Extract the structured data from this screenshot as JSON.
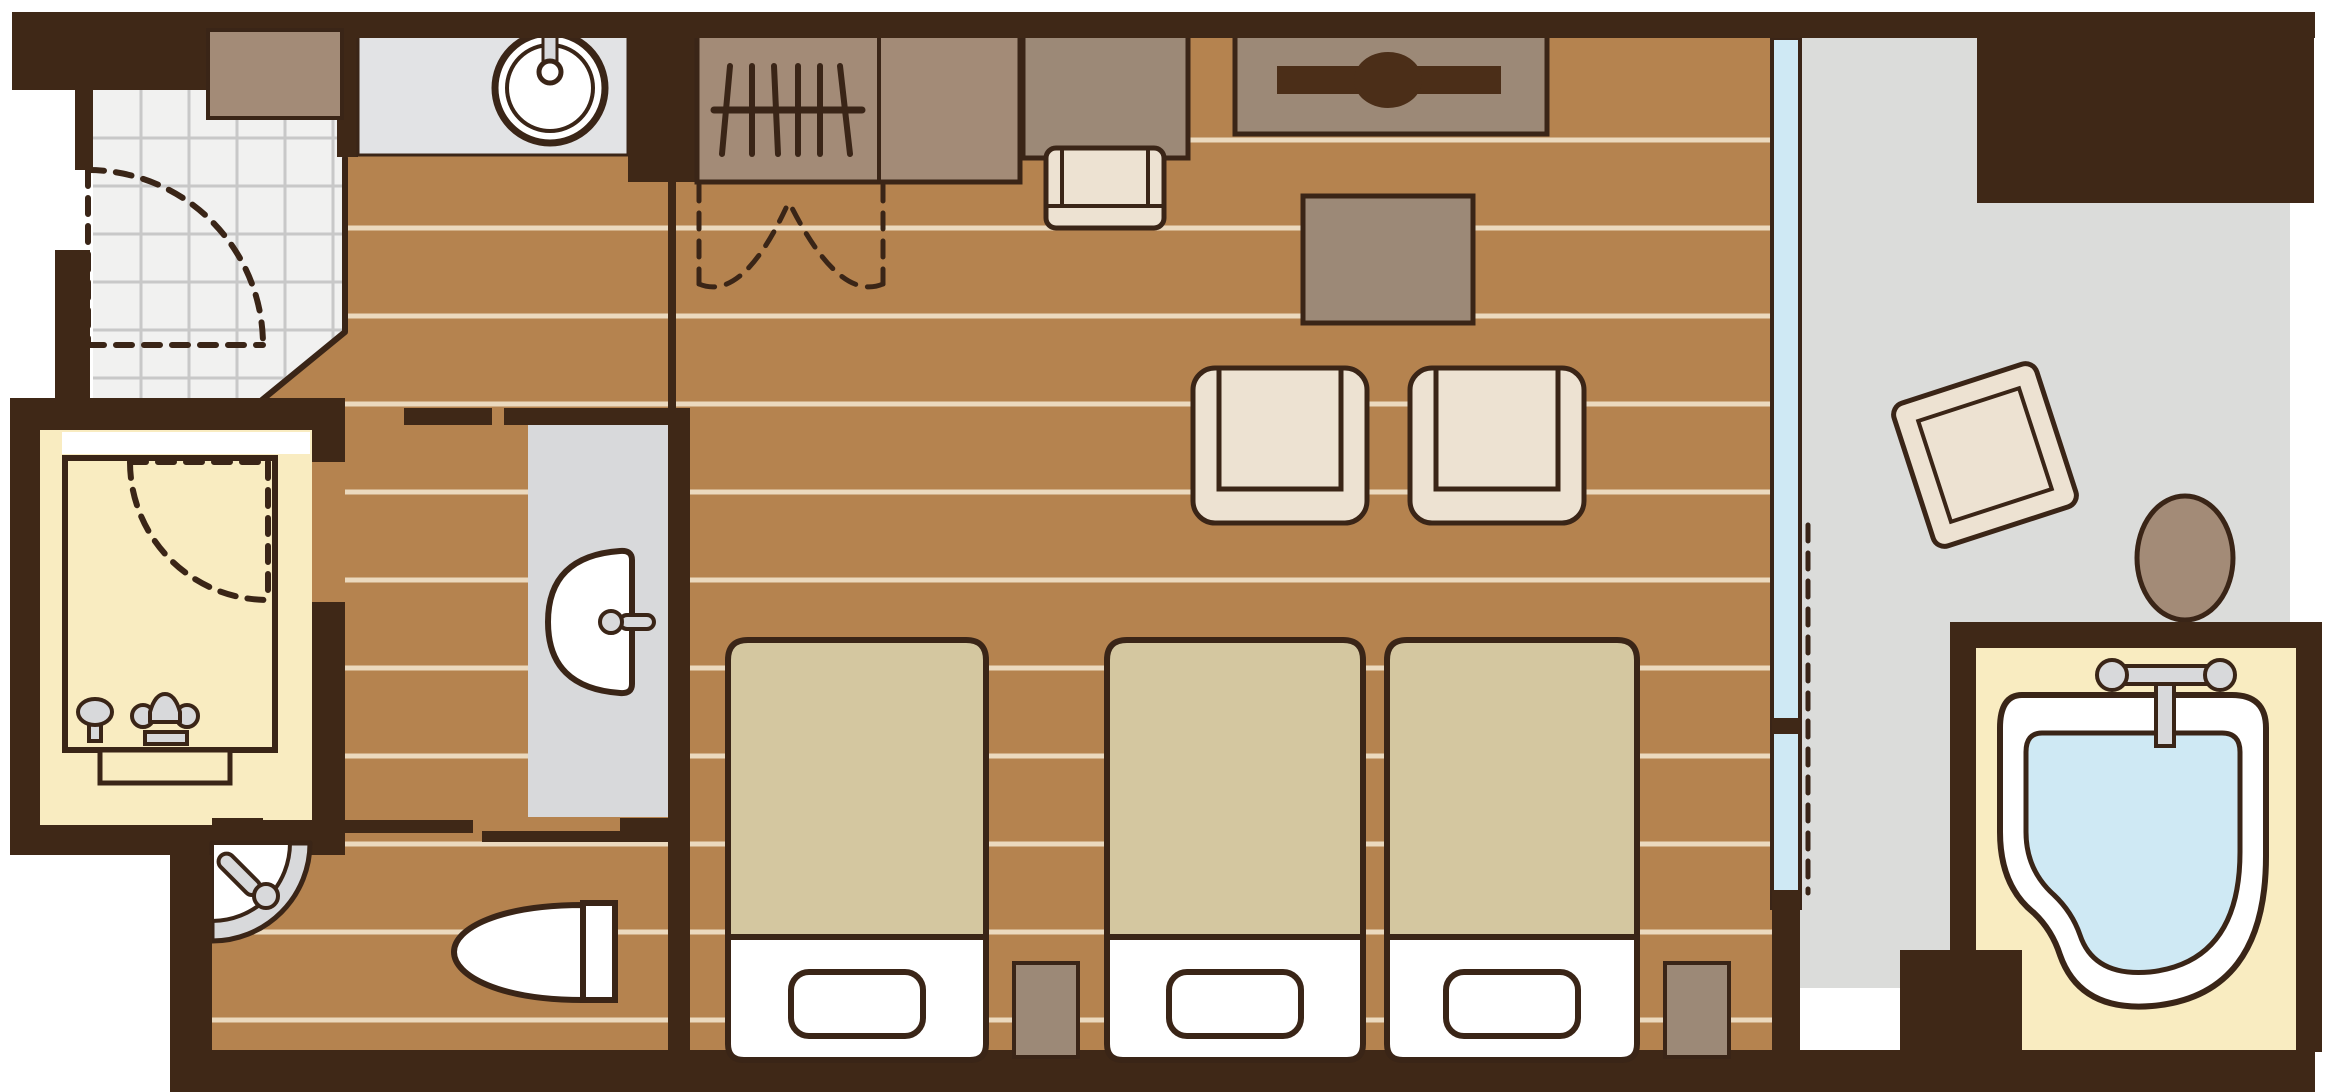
{
  "app": {
    "title": "Hotel guest room floor plan"
  },
  "canvas": {
    "width": 2328,
    "height": 1092
  },
  "colors": {
    "bg": "#FFFFFF",
    "outline": "#3A2517",
    "wall": "#3F2817",
    "wood_floor": "#B5834F",
    "plank_line": "#EBD9BE",
    "tile_floor": "#F1F1F0",
    "tile_grout": "#C8C8C8",
    "bath_floor_yellow": "#F9ECC1",
    "balcony_floor": "#DBDCDA",
    "counter_gray": "#E2E3E5",
    "vanity_gray": "#D8D9DB",
    "fixture_gray": "#D8D9DB",
    "furniture_brown": "#9C8977",
    "closet_brown": "#A38B77",
    "furniture_cream": "#EDE2D2",
    "bed_tan": "#D4C7A0",
    "linen_white": "#FFFFFF",
    "water_blue": "#CFE9F4",
    "window_blue": "#CFE9F4",
    "tv_dark": "#4B2E18"
  },
  "rooms": [
    {
      "id": "entrance",
      "label": "Entrance (tiled genkan)"
    },
    {
      "id": "bathroom",
      "label": "Bathroom with bathtub and shower"
    },
    {
      "id": "toilet-room",
      "label": "Toilet room with corner basin"
    },
    {
      "id": "corridor",
      "label": "Corridor with vanity washbasin"
    },
    {
      "id": "bedroom",
      "label": "Bedroom / living area (wood floor)"
    },
    {
      "id": "balcony",
      "label": "Balcony terrace"
    },
    {
      "id": "open-air-bath",
      "label": "Open-air bath with heart-shaped tub"
    }
  ],
  "furniture": [
    {
      "id": "shoe-cabinet",
      "label": "Shoe cabinet",
      "count": 1
    },
    {
      "id": "sink-counter",
      "label": "Counter with round sink",
      "count": 1
    },
    {
      "id": "wardrobe",
      "label": "Wardrobe with hangers and bi-fold doors",
      "count": 1
    },
    {
      "id": "desk",
      "label": "Desk with chair",
      "count": 1
    },
    {
      "id": "tv-board",
      "label": "TV on low board",
      "count": 1
    },
    {
      "id": "low-table",
      "label": "Low table",
      "count": 1
    },
    {
      "id": "armchair",
      "label": "Armchair",
      "count": 2
    },
    {
      "id": "single-bed",
      "label": "Single bed with pillow",
      "count": 3
    },
    {
      "id": "nightstand",
      "label": "Nightstand",
      "count": 2
    },
    {
      "id": "vanity-basin",
      "label": "Vanity washbasin with faucet",
      "count": 1
    },
    {
      "id": "corner-basin",
      "label": "Corner washbasin",
      "count": 1
    },
    {
      "id": "toilet",
      "label": "Toilet with tank",
      "count": 1
    },
    {
      "id": "bathtub",
      "label": "Bathtub with shower set",
      "count": 1
    },
    {
      "id": "heart-bathtub",
      "label": "Heart-shaped bathtub with faucet",
      "count": 1
    },
    {
      "id": "balcony-table",
      "label": "Balcony table (rotated)",
      "count": 1
    },
    {
      "id": "balcony-stool",
      "label": "Round balcony stool",
      "count": 1
    },
    {
      "id": "window",
      "label": "Full-height window to balcony",
      "count": 1
    },
    {
      "id": "doors",
      "label": "Entry swing door, bathroom swing door, closet bi-fold doors, toilet sliding door",
      "count": 4
    }
  ]
}
